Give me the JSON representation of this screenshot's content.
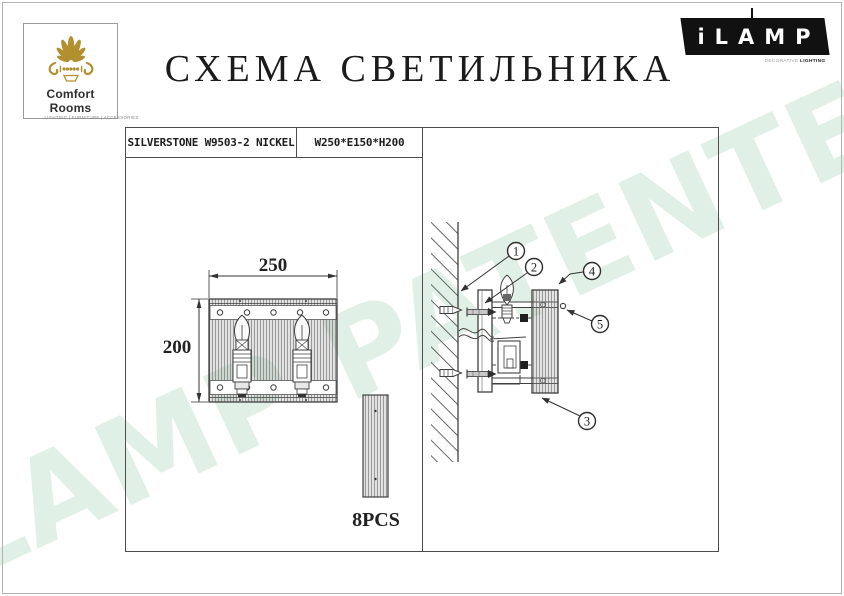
{
  "branding": {
    "comfort_rooms": {
      "name": "Comfort Rooms",
      "tagline": "LIGHTING | FURNITURE | ACCESSORIES"
    },
    "ilamp": {
      "brand": "iLAMP",
      "tagline_light": "DECORATIVE",
      "tagline_bold": "LIGHTING"
    }
  },
  "title": "СХЕМА СВЕТИЛЬНИКА",
  "spec_header": {
    "model": "SILVERSTONE W9503-2 NICKEL",
    "size": "W250*E150*H200"
  },
  "front_view": {
    "width_mm": "250",
    "height_mm": "200",
    "rod_count_label": "8PCS"
  },
  "installation_view": {
    "callouts": [
      "1",
      "2",
      "3",
      "4",
      "5"
    ]
  },
  "watermark": {
    "text": "iLAMP PATENTED",
    "color": "#e0f0e6"
  },
  "colors": {
    "logo_gold": "#b2902f",
    "line_ink": "#3f3f3f",
    "box_border": "#4d4d4d"
  }
}
